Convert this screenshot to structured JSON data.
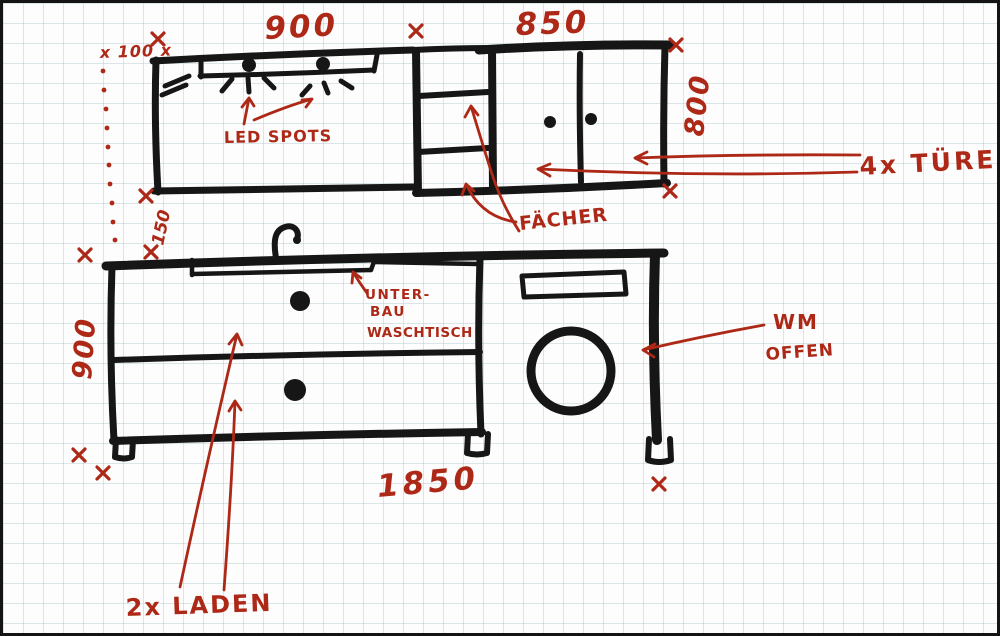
{
  "colors": {
    "ink": "#161616",
    "annotation_red": "#ad2817",
    "grid_line": "#d9e3e6",
    "paper": "#fcfdfc"
  },
  "upper_cabinets": {
    "width_left_mm": "900",
    "width_right_mm": "850",
    "height_right_mm": "800",
    "top_offset_mm": "x 100 x",
    "gap_below_mm": "150",
    "led_label": "LED SPOTS",
    "shelves_label": "FÄCHER",
    "doors_label": "4x TÜRE"
  },
  "base_cabinets": {
    "height_left_mm": "900",
    "total_width_mm": "1850",
    "sink_label_line1": "UNTER-",
    "sink_label_line2": "BAU",
    "sink_label_line3": "WASCHTISCH",
    "wm_label_line1": "WM",
    "wm_label_line2": "OFFEN",
    "drawers_label": "2x LADEN"
  }
}
